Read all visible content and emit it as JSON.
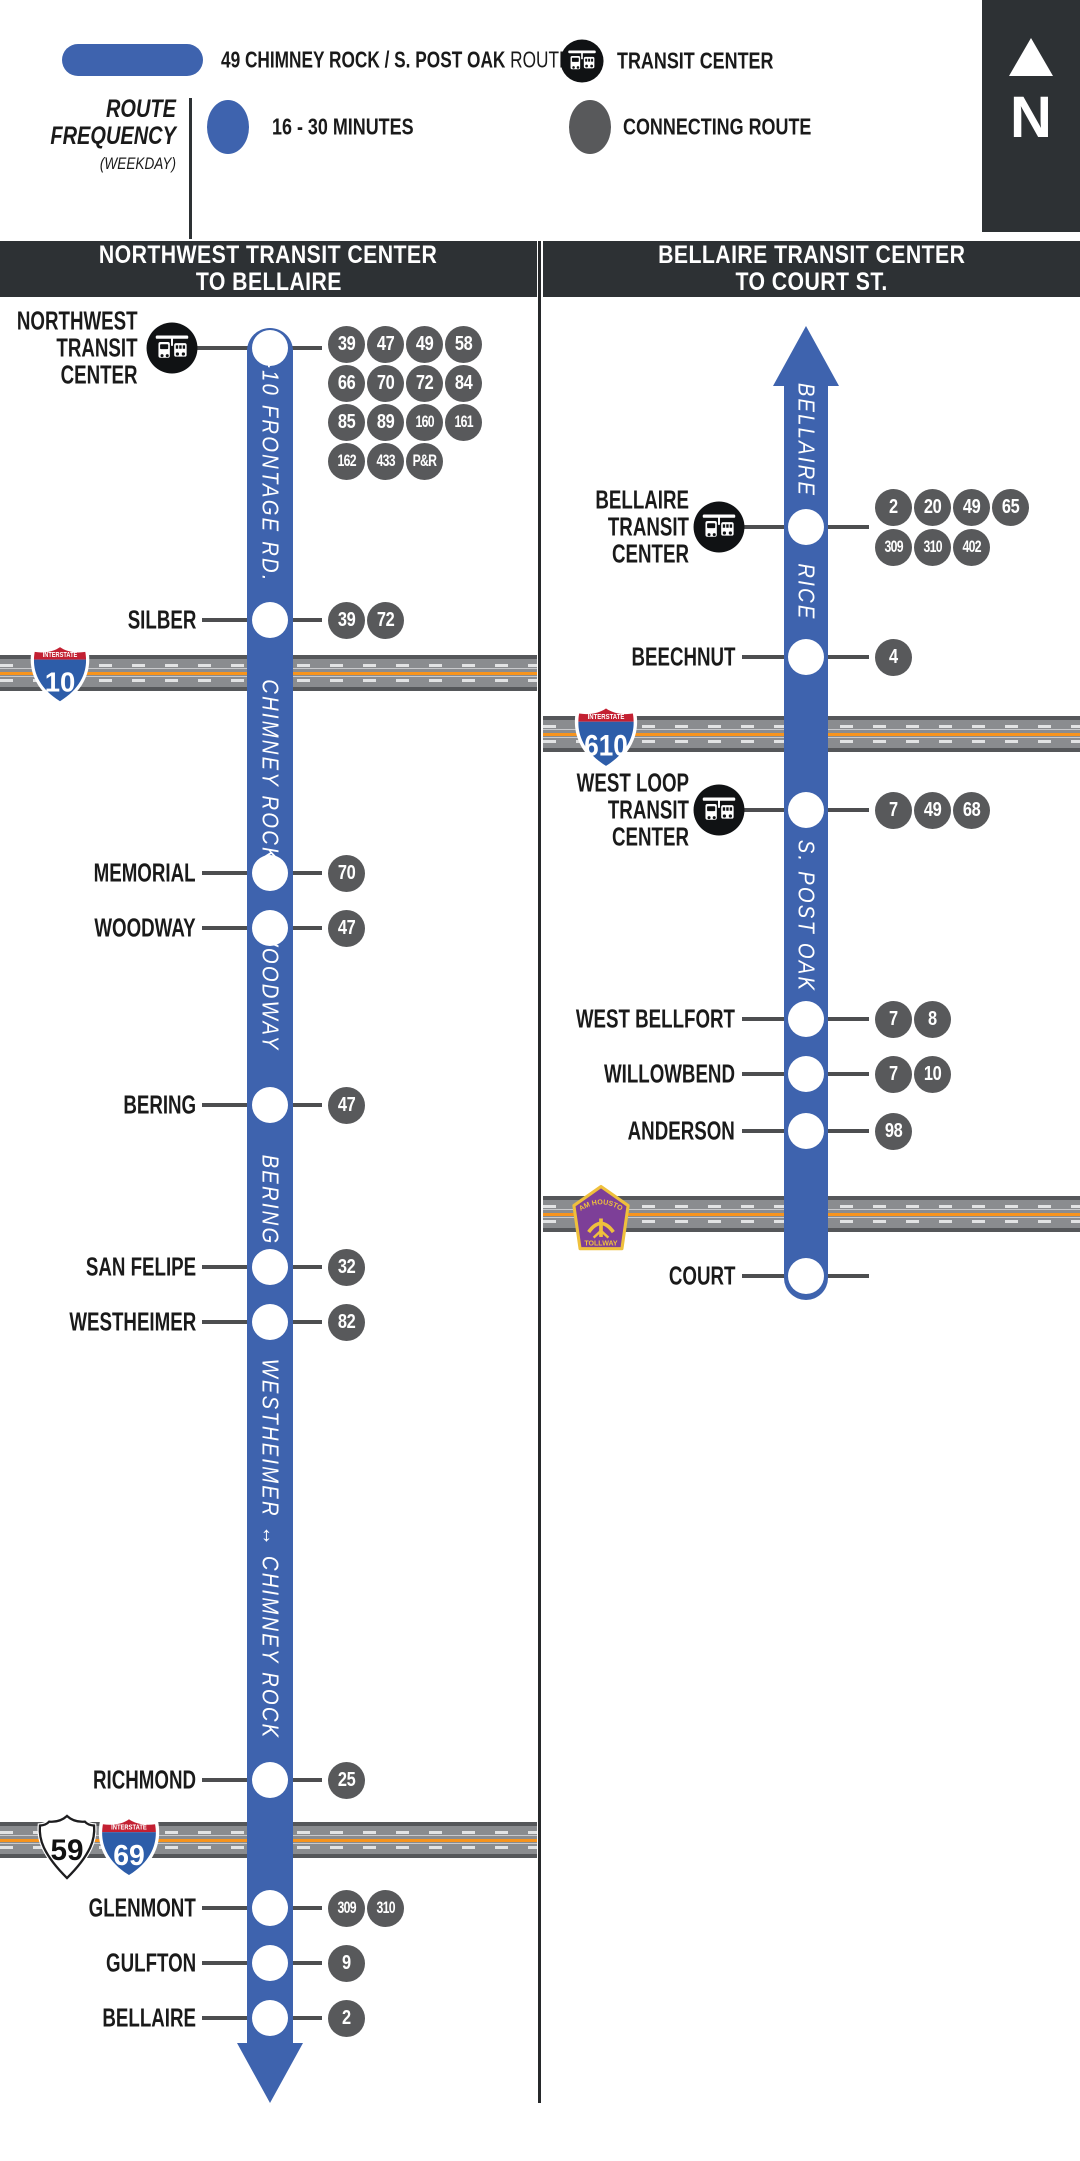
{
  "legend": {
    "route_name": "49 CHIMNEY ROCK / S. POST OAK",
    "route_suffix": "ROUTE",
    "transit_center_label": "TRANSIT CENTER",
    "frequency_title_line1": "ROUTE",
    "frequency_title_line2": "FREQUENCY",
    "frequency_subtitle": "(WEEKDAY)",
    "frequency_value": "16 - 30 MINUTES",
    "connecting_route_label": "CONNECTING ROUTE",
    "north_label": "N"
  },
  "colors": {
    "route_blue": "#3E63AE",
    "connector_gray": "#58595B",
    "panel_dark": "#2D3134",
    "tick_gray": "#4D4E50",
    "road_gray": "#8A8C8F",
    "road_edge": "#55575A",
    "road_orange": "#F7941D",
    "interstate_red": "#C32032",
    "interstate_blue": "#2D5DA9",
    "toll_purple": "#7D3F98",
    "toll_gold": "#EFC03C"
  },
  "columns": [
    {
      "header_line1": "NORTHWEST TRANSIT CENTER",
      "header_line2": "TO BELLAIRE",
      "direction": "down",
      "street_labels": [
        {
          "text": "I-10 FRONTAGE RD.",
          "y": 468
        },
        {
          "text": "CHIMNEY ROCK",
          "y": 771
        },
        {
          "text": "WOODWAY",
          "y": 989
        },
        {
          "text": "BERING",
          "y": 1200
        },
        {
          "text": "WESTHEIMER ↔ CHIMNEY ROCK",
          "y": 1549
        }
      ],
      "stops": [
        {
          "name_lines": [
            "NORTHWEST",
            "TRANSIT",
            "CENTER"
          ],
          "y": 348,
          "transit_center": true,
          "connection_rows": [
            [
              "39",
              "47",
              "49",
              "58"
            ],
            [
              "66",
              "70",
              "72",
              "84"
            ],
            [
              "85",
              "89",
              "160",
              "161"
            ],
            [
              "162",
              "433",
              "P&R"
            ]
          ],
          "row_offsets": [
            -4,
            35,
            74,
            113
          ]
        },
        {
          "name_lines": [
            "SILBER"
          ],
          "y": 620,
          "transit_center": false,
          "connection_rows": [
            [
              "39",
              "72"
            ]
          ],
          "row_offsets": [
            0
          ]
        },
        {
          "name_lines": [
            "MEMORIAL"
          ],
          "y": 873,
          "transit_center": false,
          "connection_rows": [
            [
              "70"
            ]
          ],
          "row_offsets": [
            0
          ]
        },
        {
          "name_lines": [
            "WOODWAY"
          ],
          "y": 928,
          "transit_center": false,
          "connection_rows": [
            [
              "47"
            ]
          ],
          "row_offsets": [
            0
          ]
        },
        {
          "name_lines": [
            "BERING"
          ],
          "y": 1105,
          "transit_center": false,
          "connection_rows": [
            [
              "47"
            ]
          ],
          "row_offsets": [
            0
          ]
        },
        {
          "name_lines": [
            "SAN FELIPE"
          ],
          "y": 1267,
          "transit_center": false,
          "connection_rows": [
            [
              "32"
            ]
          ],
          "row_offsets": [
            0
          ]
        },
        {
          "name_lines": [
            "WESTHEIMER"
          ],
          "y": 1322,
          "transit_center": false,
          "connection_rows": [
            [
              "82"
            ]
          ],
          "row_offsets": [
            0
          ]
        },
        {
          "name_lines": [
            "RICHMOND"
          ],
          "y": 1780,
          "transit_center": false,
          "connection_rows": [
            [
              "25"
            ]
          ],
          "row_offsets": [
            0
          ]
        },
        {
          "name_lines": [
            "GLENMONT"
          ],
          "y": 1908,
          "transit_center": false,
          "connection_rows": [
            [
              "309",
              "310"
            ]
          ],
          "row_offsets": [
            0
          ]
        },
        {
          "name_lines": [
            "GULFTON"
          ],
          "y": 1963,
          "transit_center": false,
          "connection_rows": [
            [
              "9"
            ]
          ],
          "row_offsets": [
            0
          ]
        },
        {
          "name_lines": [
            "BELLAIRE"
          ],
          "y": 2018,
          "transit_center": false,
          "connection_rows": [
            [
              "2"
            ]
          ],
          "row_offsets": [
            0
          ]
        }
      ],
      "crossings": [
        {
          "band_y": 655,
          "shields": [
            {
              "type": "interstate",
              "banner": "INTERSTATE",
              "number": "10",
              "x": 28,
              "y": 642,
              "w": 64
            }
          ]
        },
        {
          "band_y": 1822,
          "shields": [
            {
              "type": "us",
              "number": "59",
              "x": 34,
              "y": 1814,
              "w": 66
            },
            {
              "type": "interstate",
              "banner": "INTERSTATE",
              "number": "69",
              "x": 96,
              "y": 1814,
              "w": 66
            }
          ]
        }
      ]
    },
    {
      "header_line1": "BELLAIRE TRANSIT CENTER",
      "header_line2": "TO COURT ST.",
      "direction": "up",
      "street_labels": [
        {
          "text": "BELLAIRE",
          "y": 440
        },
        {
          "text": "RICE",
          "y": 592
        },
        {
          "text": "S. POST OAK",
          "y": 916
        }
      ],
      "stops": [
        {
          "name_lines": [
            "BELLAIRE",
            "TRANSIT",
            "CENTER"
          ],
          "y": 527,
          "transit_center": true,
          "connection_rows": [
            [
              "2",
              "20",
              "49",
              "65"
            ],
            [
              "309",
              "310",
              "402"
            ]
          ],
          "row_offsets": [
            -20,
            20
          ]
        },
        {
          "name_lines": [
            "BEECHNUT"
          ],
          "y": 657,
          "transit_center": false,
          "connection_rows": [
            [
              "4"
            ]
          ],
          "row_offsets": [
            0
          ]
        },
        {
          "name_lines": [
            "WEST LOOP",
            "TRANSIT",
            "CENTER"
          ],
          "y": 810,
          "transit_center": true,
          "connection_rows": [
            [
              "7",
              "49",
              "68"
            ]
          ],
          "row_offsets": [
            0
          ]
        },
        {
          "name_lines": [
            "WEST BELLFORT"
          ],
          "y": 1019,
          "transit_center": false,
          "connection_rows": [
            [
              "7",
              "8"
            ]
          ],
          "row_offsets": [
            0
          ]
        },
        {
          "name_lines": [
            "WILLOWBEND"
          ],
          "y": 1074,
          "transit_center": false,
          "connection_rows": [
            [
              "7",
              "10"
            ]
          ],
          "row_offsets": [
            0
          ]
        },
        {
          "name_lines": [
            "ANDERSON"
          ],
          "y": 1131,
          "transit_center": false,
          "connection_rows": [
            [
              "98"
            ]
          ],
          "row_offsets": [
            0
          ]
        },
        {
          "name_lines": [
            "COURT"
          ],
          "y": 1276,
          "transit_center": false,
          "connection_rows": [],
          "row_offsets": []
        }
      ],
      "crossings": [
        {
          "band_y": 716,
          "shields": [
            {
              "type": "interstate",
              "banner": "INTERSTATE",
              "number": "610",
              "x": 572,
              "y": 703,
              "w": 68
            }
          ]
        },
        {
          "band_y": 1196,
          "shields": [
            {
              "type": "tollway",
              "top": "SAM HOUSTON",
              "bottom": "TOLLWAY",
              "x": 570,
              "y": 1184,
              "w": 62
            }
          ]
        }
      ]
    }
  ]
}
